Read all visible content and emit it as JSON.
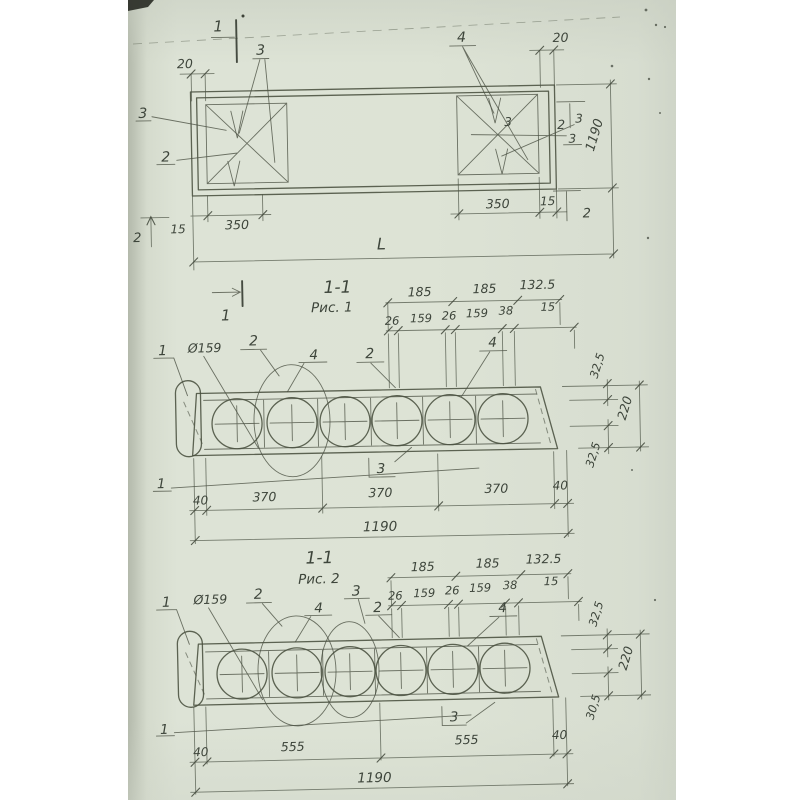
{
  "colors": {
    "paper": "#dbe1d4",
    "ink": "#434a3e",
    "background": "#ffffff"
  },
  "plan": {
    "section_marker_top": "1",
    "section_marker_bottom": "1",
    "dim_offset_left": "20",
    "dim_offset_right": "20",
    "dim_height": "1190",
    "dim_mesh_left": "350",
    "dim_edge_left": "15",
    "dim_mesh_right": "350",
    "dim_edge_right": "15",
    "dim_length": "L",
    "pos_left": "2",
    "pos_right": "2",
    "callout_top_left": "3",
    "callout_top_right": "4",
    "callout_left_a": "3",
    "callout_left_b": "2",
    "callout_inner_right": "3",
    "callout_right_a": "2",
    "callout_right_b": "3",
    "callout_right_c": "3"
  },
  "fig1": {
    "title": "1-1",
    "caption": "Рис. 1",
    "span_dims": [
      "185",
      "185",
      "132.5"
    ],
    "detail_dims": [
      "26",
      "159",
      "26",
      "159",
      "38",
      "15"
    ],
    "callout_loop": "1",
    "callout_diameter": "Ø159",
    "callout_mesh_a": "2",
    "callout_a": "4",
    "callout_mesh_b": "2",
    "callout_b": "4",
    "callout_boxed": "3",
    "callout_rebar": "1",
    "height_dims": [
      "32,5",
      "220",
      "32,5"
    ],
    "bottom_dims": [
      "40",
      "370",
      "370",
      "370",
      "40"
    ],
    "dim_total": "1190"
  },
  "fig2": {
    "title": "1-1",
    "caption": "Рис. 2",
    "span_dims": [
      "185",
      "185",
      "132.5"
    ],
    "detail_dims": [
      "26",
      "159",
      "26",
      "159",
      "38",
      "15"
    ],
    "callout_loop": "1",
    "callout_diameter": "Ø159",
    "callout_mesh_a": "2",
    "callout_a": "4",
    "callout_hole": "3",
    "callout_mesh_b": "2",
    "callout_b": "4",
    "callout_boxed": "3",
    "callout_rebar": "1",
    "height_dims": [
      "32,5",
      "220",
      "30,5"
    ],
    "bottom_dims": [
      "40",
      "555",
      "555",
      "40"
    ],
    "dim_total": "1190"
  }
}
